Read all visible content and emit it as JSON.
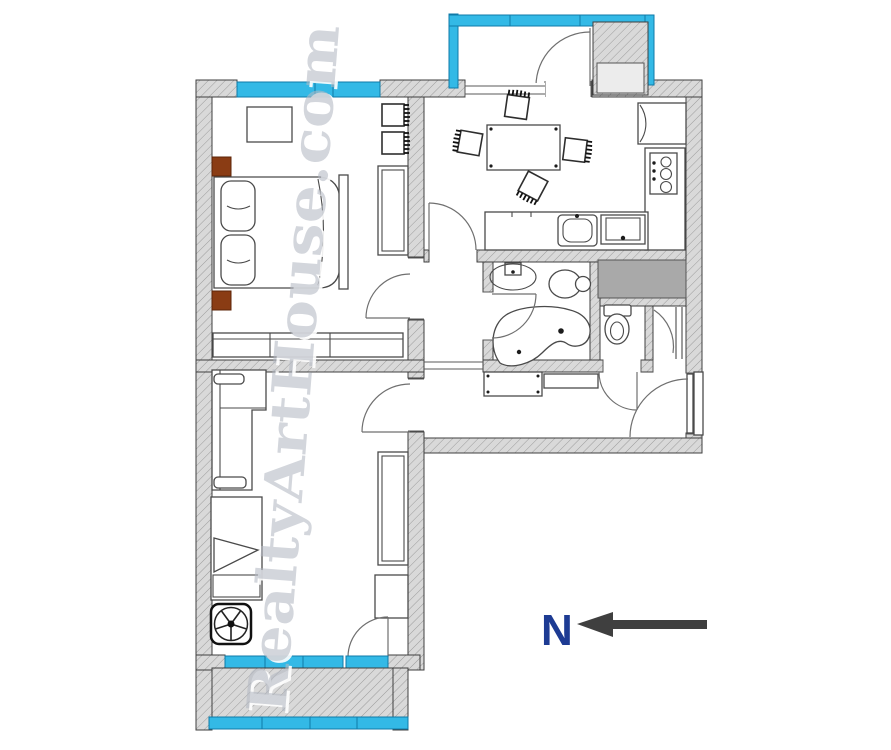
{
  "watermark": {
    "text": "RealtyArtHouse.com"
  },
  "compass": {
    "label": "N"
  },
  "colors": {
    "window": "#33b9e6",
    "window_border": "#0f7aa8",
    "wall_fill": "#d9d9d9",
    "hatch_line": "#9b9b9b",
    "wall_outline": "#3f3f3f",
    "accent_brown": "#8a3c14",
    "shaft_gray": "#a9a9a9",
    "north_letter": "#1d3b93",
    "arrow": "#3f3f3f",
    "watermark_gray": "#b4b9c3",
    "line": "#4a4a4a"
  }
}
